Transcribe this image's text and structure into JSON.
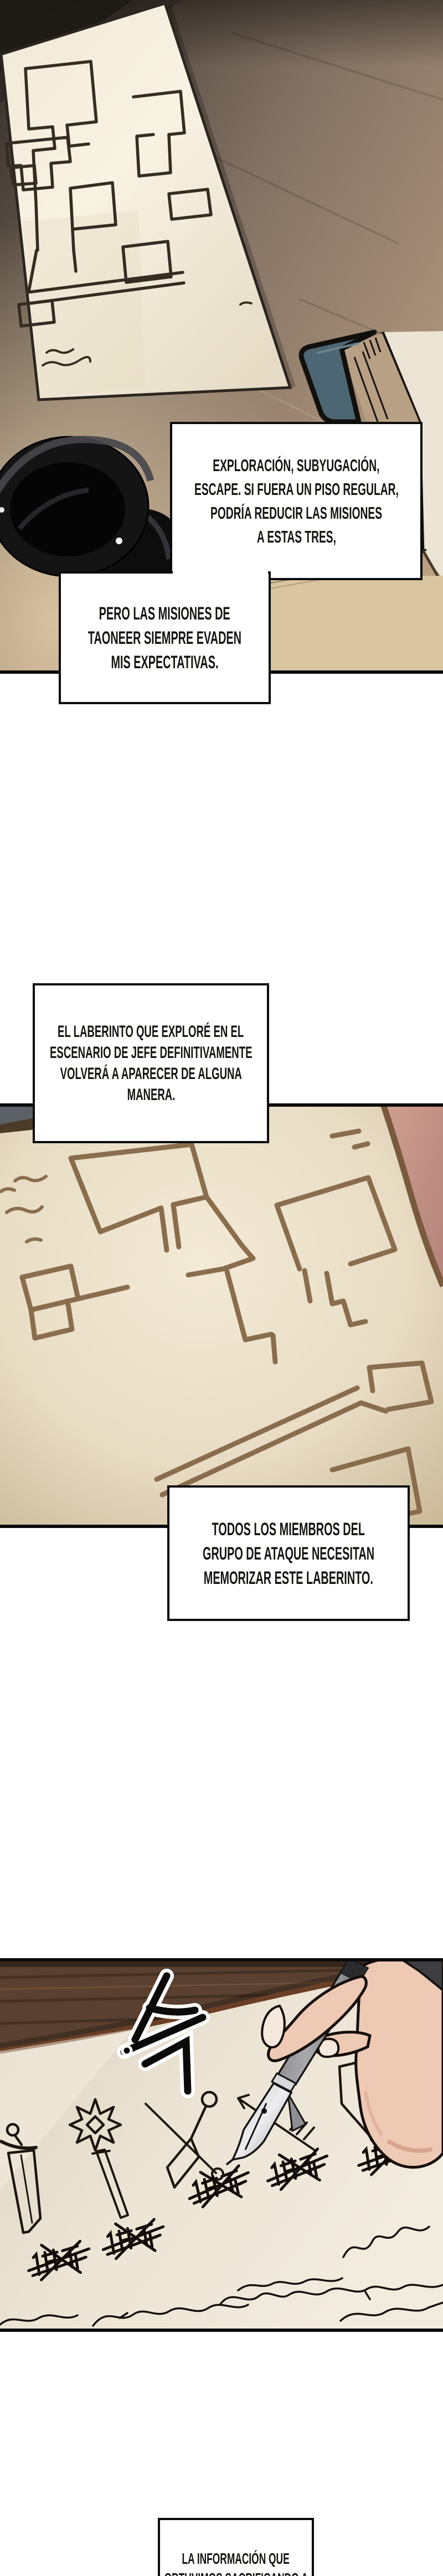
{
  "meta": {
    "kind": "manhwa-webtoon-page",
    "language": "es"
  },
  "colors": {
    "page_bg": "#ffffff",
    "panel_border": "#0b0b0b",
    "sketch_ink": "#1c150e",
    "wood_dark": "#2c2723",
    "wood_light": "#c9b08c",
    "paper_cream": "#f2ead8",
    "map_paper": "#ece2cc",
    "map_line": "#8a6d4c",
    "panel3_wood": "#5a4030",
    "skin": "#eec9b4",
    "pen_grey": "#9a9a9a",
    "book_cover_teal": "#4d6673",
    "book_pages_tan": "#b7a084",
    "ink_bottle_black": "#141414",
    "corner_blue_grey": "#5b6167",
    "desk_pink": "#c99a8b"
  },
  "narration": {
    "box1": {
      "lines": [
        "EXPLORACIÓN, SUBYUGACIÓN,",
        "ESCAPE. SI FUERA UN PISO REGULAR,",
        "PODRÍA REDUCIR LAS MISIONES",
        "A ESTAS TRES,"
      ]
    },
    "box2": {
      "lines": [
        "PERO LAS MISIONES DE",
        "TAONEER SIEMPRE EVADEN",
        "MIS EXPECTATIVAS."
      ]
    },
    "box3": {
      "lines": [
        "EL LABERINTO QUE EXPLORÉ EN EL",
        "ESCENARIO DE JEFE DEFINITIVAMENTE",
        "VOLVERÁ A APARECER DE ALGUNA",
        "MANERA."
      ]
    },
    "box4": {
      "lines": [
        "TODOS LOS MIEMBROS DEL",
        "GRUPO DE ATAQUE NECESITAN",
        "MEMORIZAR ESTE LABERINTO."
      ]
    },
    "box5": {
      "lines": [
        "LA INFORMACIÓN QUE",
        "OBTUVIMOS SACRIFICANDO A"
      ]
    }
  },
  "panels": [
    {
      "name": "panel-1",
      "description": "Hand-drawn dungeon maze map on paper lying on a wooden desk with a black ink bottle and a teal book"
    },
    {
      "name": "panel-2",
      "description": "Close-up of the hand-drawn maze on aged paper"
    },
    {
      "name": "panel-3",
      "description": "Hand with a fountain pen crossing out party labels beside sketches of a sword, mace, kunai, arrow and shield"
    }
  ]
}
